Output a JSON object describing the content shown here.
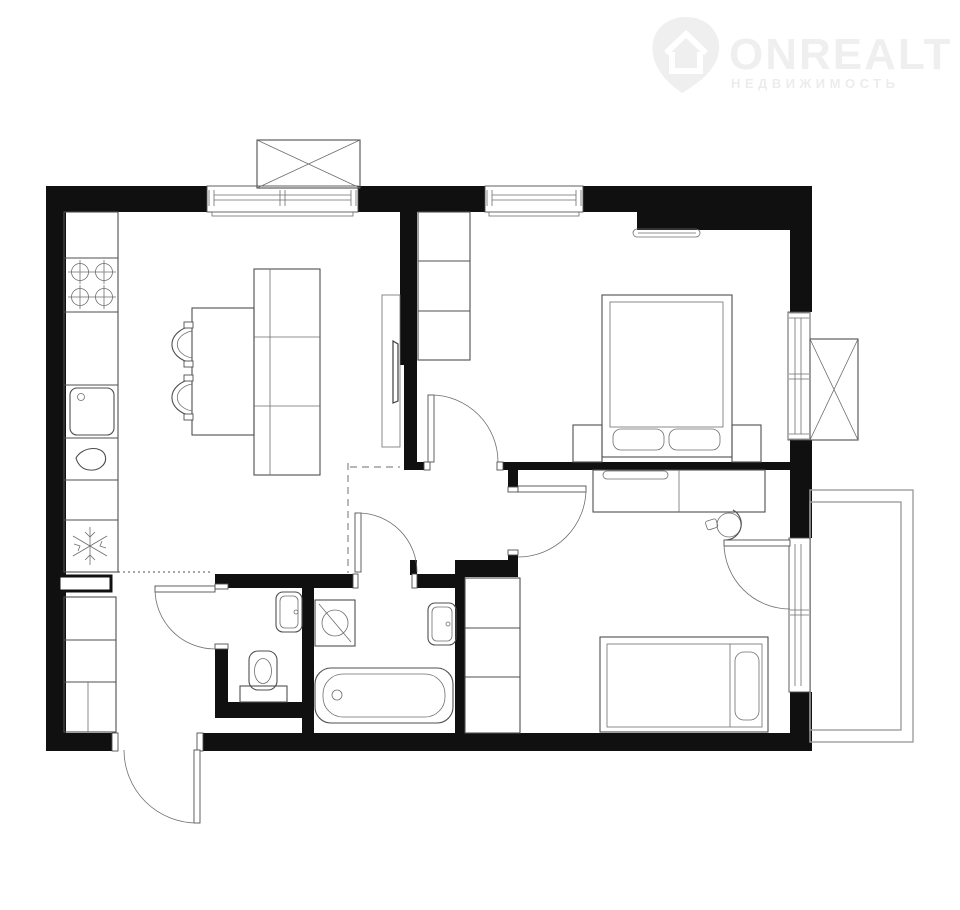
{
  "brand": {
    "name": "ONREALT",
    "subtitle": "НЕДВИЖИМОСТЬ",
    "icon": "location-pin-house-icon"
  },
  "colors": {
    "bg": "#ffffff",
    "wall": "#101010",
    "line": "#4f4f4f",
    "thin": "#6e6e6e",
    "light": "#9e9e9e",
    "dash": "#8a8a8a",
    "logo": "#efefef",
    "logo_sub": "#ececec"
  },
  "plan": {
    "type": "apartment-floor-plan",
    "rooms": [
      {
        "name": "kitchen-living-room",
        "fixtures": [
          "counter-run",
          "stove-4-burners",
          "kitchen-sink",
          "faucet",
          "refrigerator",
          "dining-table",
          "two-chairs",
          "sofa-cabinet",
          "tv-console",
          "window",
          "vent-box"
        ]
      },
      {
        "name": "bedroom-1",
        "fixtures": [
          "wardrobe-3-sections",
          "wall-shelf",
          "double-bed",
          "two-pillows",
          "two-nightstands",
          "top-window",
          "side-window",
          "ac-box"
        ]
      },
      {
        "name": "bedroom-2",
        "fixtures": [
          "desk-dresser",
          "laptop",
          "desk-chair",
          "single-bed",
          "pillow",
          "wardrobe-3-sections",
          "balcony-door"
        ]
      },
      {
        "name": "hallway",
        "fixtures": [
          "closet-cells",
          "niche-cabinet",
          "dashed-zone-boundary"
        ]
      },
      {
        "name": "toilet-room",
        "fixtures": [
          "toilet",
          "wash-basin"
        ]
      },
      {
        "name": "bathroom",
        "fixtures": [
          "washing-machine",
          "wash-basin",
          "bathtub"
        ]
      },
      {
        "name": "balcony",
        "fixtures": []
      }
    ],
    "openings": [
      "entry-door",
      "bedroom-1-door",
      "bedroom-2-door",
      "bathroom-door",
      "toilet-door",
      "balcony-door",
      "kitchen-window",
      "bedroom-1-window",
      "bedroom-1-side-window"
    ]
  }
}
